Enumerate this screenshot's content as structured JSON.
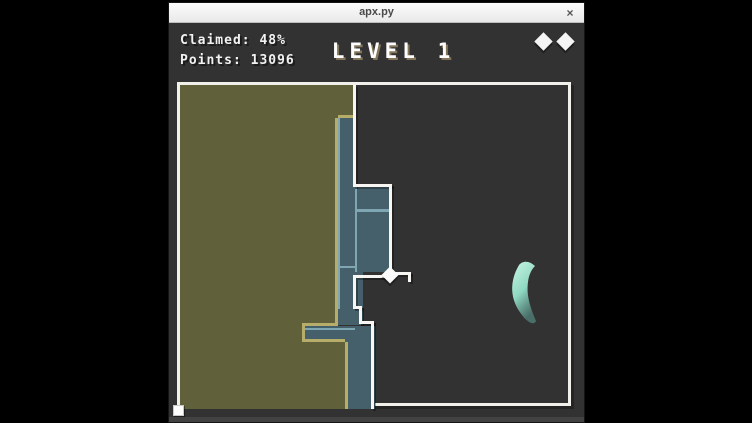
{
  "window": {
    "title": "apx.py",
    "close_label": "×"
  },
  "hud": {
    "claimed_label": "Claimed: 48%",
    "claimed_percent": 48,
    "points_label": "Points: 13096",
    "points": 13096,
    "level_label": "LEVEL 1",
    "level": 1,
    "lives": 2
  },
  "colors": {
    "field_bg": "#323232",
    "claimed": "#60603a",
    "claimed_border": "#b5ad69",
    "trail": "#45606a",
    "trail_border": "#7fa6b3",
    "path": "#f7f6f2",
    "enemy_bright": "#c9f6e3",
    "enemy_dark": "#5a8a80",
    "hud_shadow": "#82755a"
  }
}
